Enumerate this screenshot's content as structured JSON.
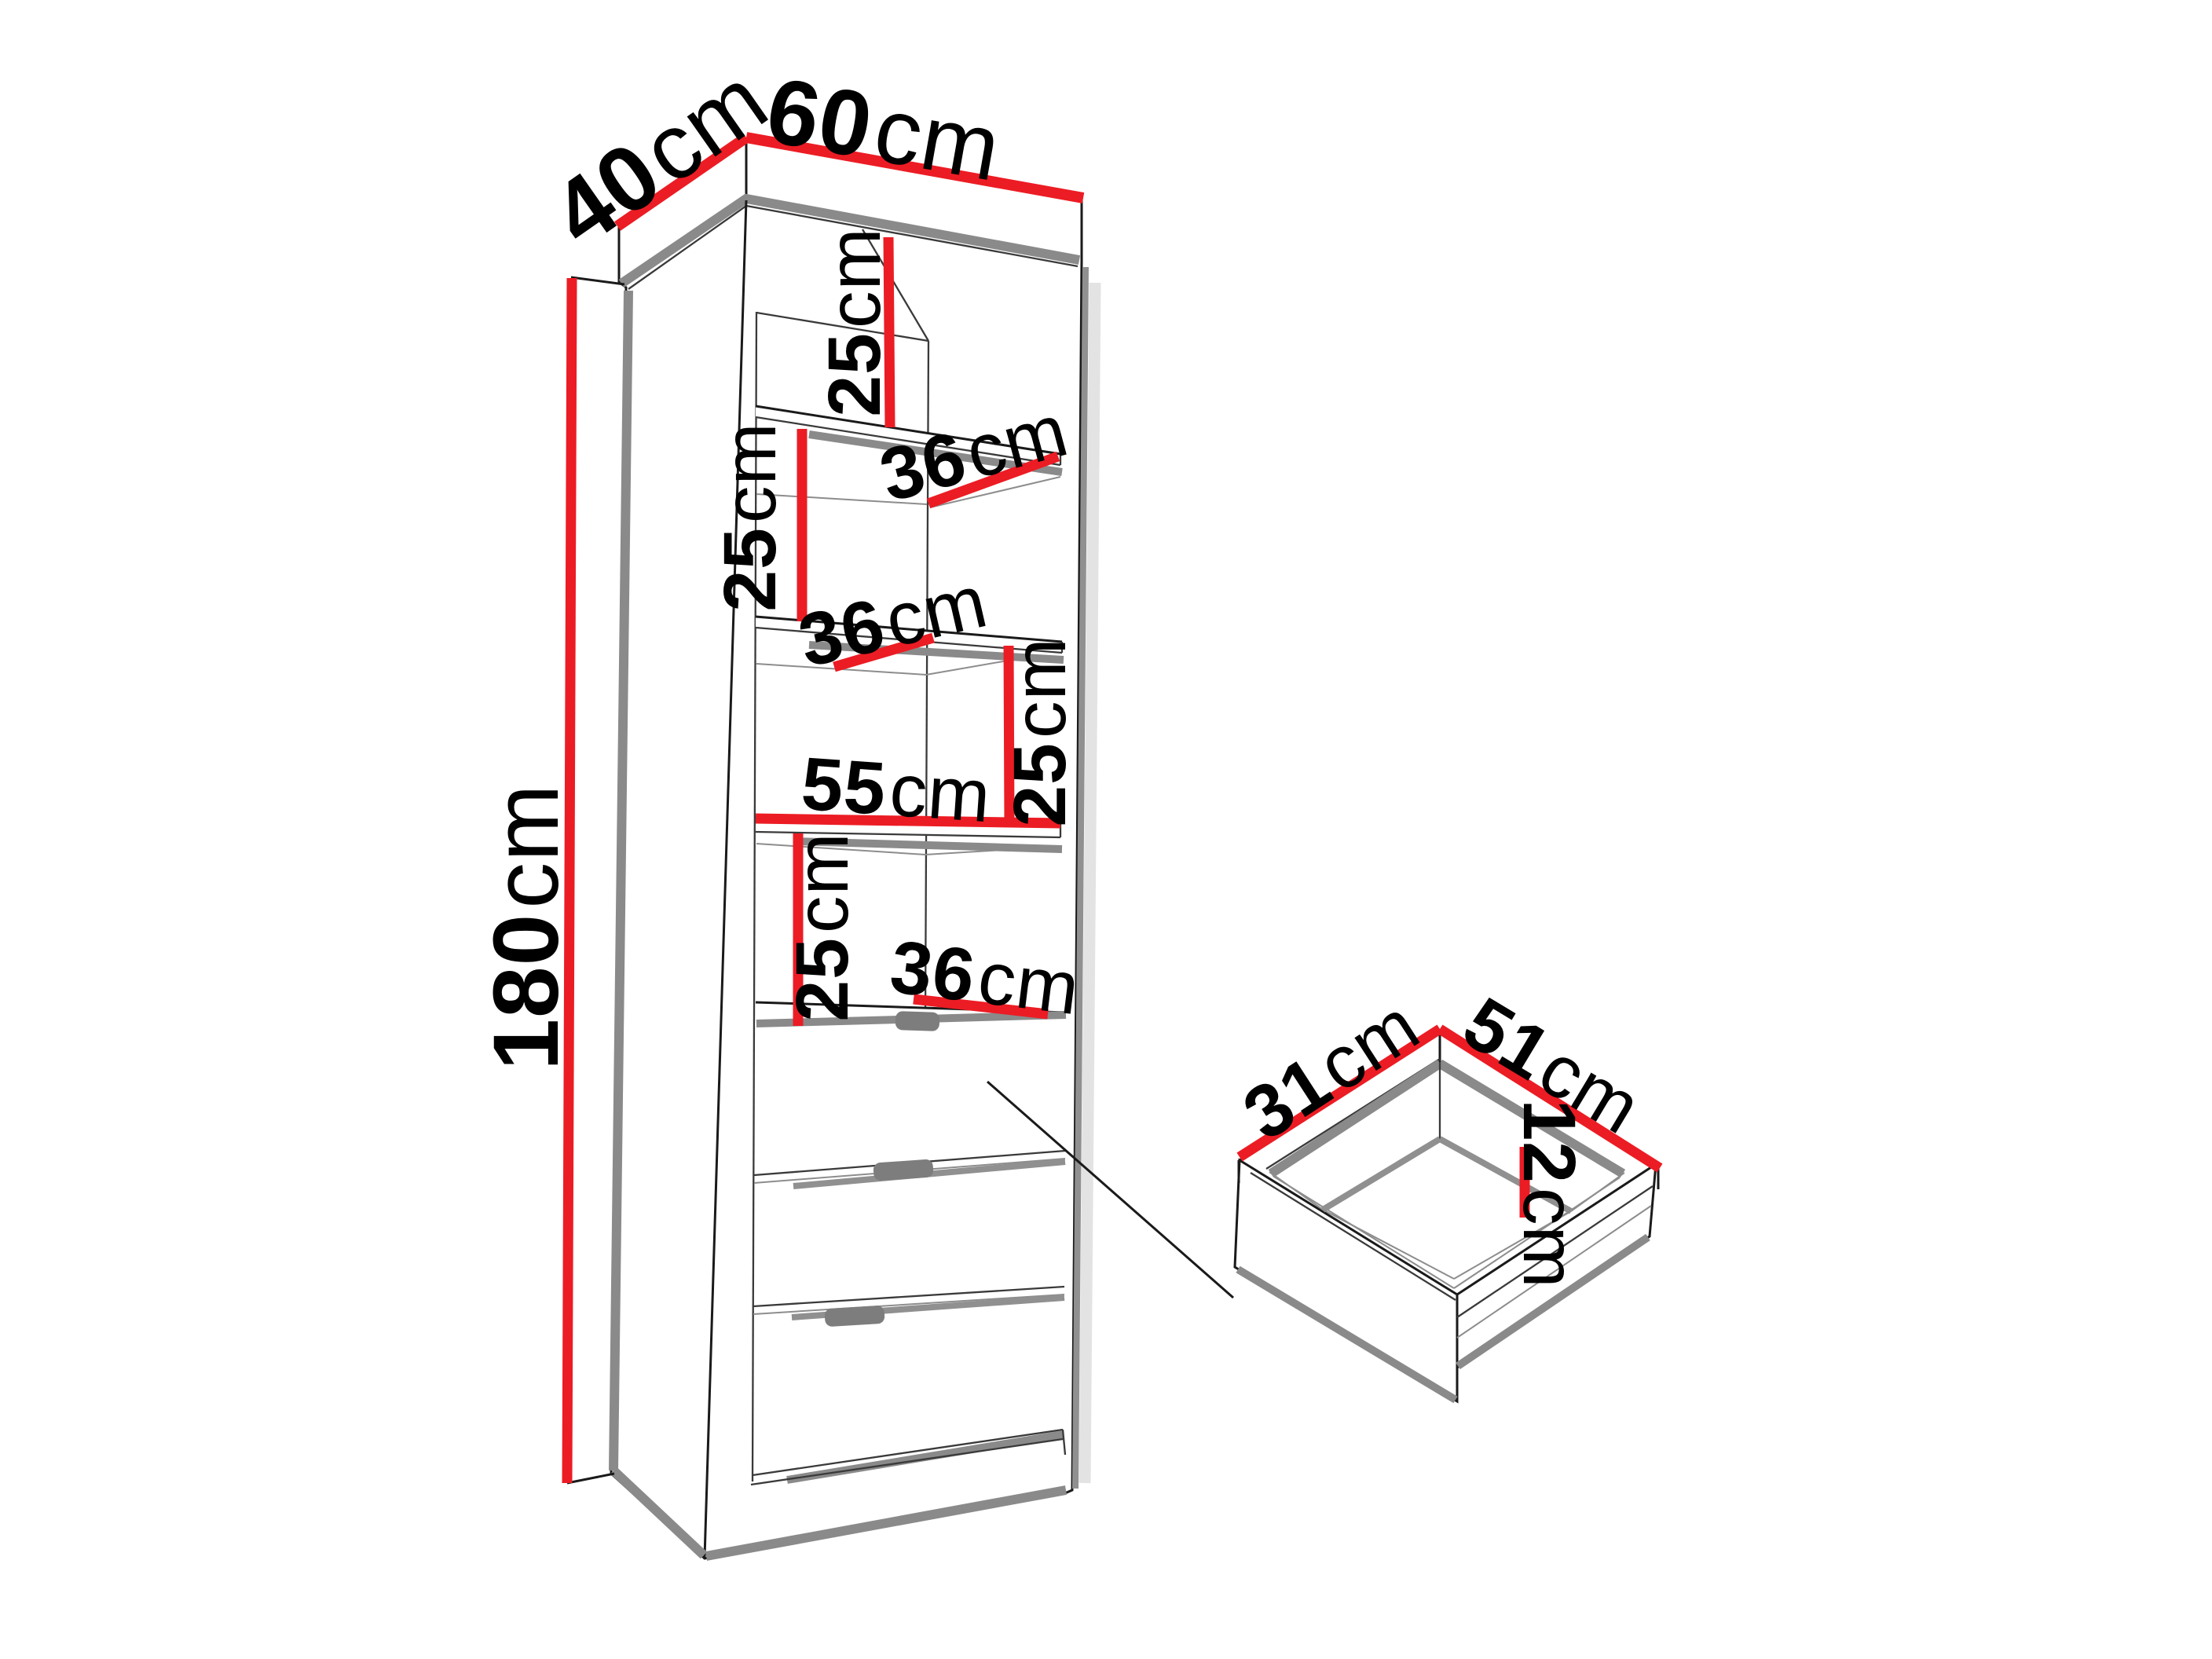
{
  "diagram": {
    "type": "furniture-dimension-diagram",
    "colors": {
      "dimension_line": "#ec1c24",
      "outline": "#1a1a1a",
      "shadow": "#8a8a8a",
      "background": "#ffffff"
    },
    "cabinet": {
      "top_width": {
        "value": "60",
        "unit": "cm"
      },
      "top_depth": {
        "value": "40",
        "unit": "cm"
      },
      "height": {
        "value": "180",
        "unit": "cm"
      },
      "interior_width": {
        "value": "55",
        "unit": "cm"
      },
      "compartment_height_1": {
        "value": "25",
        "unit": "cm"
      },
      "compartment_height_2": {
        "value": "25",
        "unit": "cm"
      },
      "compartment_height_3": {
        "value": "25",
        "unit": "cm"
      },
      "compartment_height_4": {
        "value": "25",
        "unit": "cm"
      },
      "shelf_depth_1": {
        "value": "36",
        "unit": "cm"
      },
      "shelf_depth_2": {
        "value": "36",
        "unit": "cm"
      },
      "shelf_depth_3": {
        "value": "36",
        "unit": "cm"
      }
    },
    "drawer_detail": {
      "side_depth": {
        "value": "31",
        "unit": "cm"
      },
      "front_width": {
        "value": "51",
        "unit": "cm"
      },
      "inner_height": {
        "value": "12",
        "unit": "cm"
      }
    }
  }
}
